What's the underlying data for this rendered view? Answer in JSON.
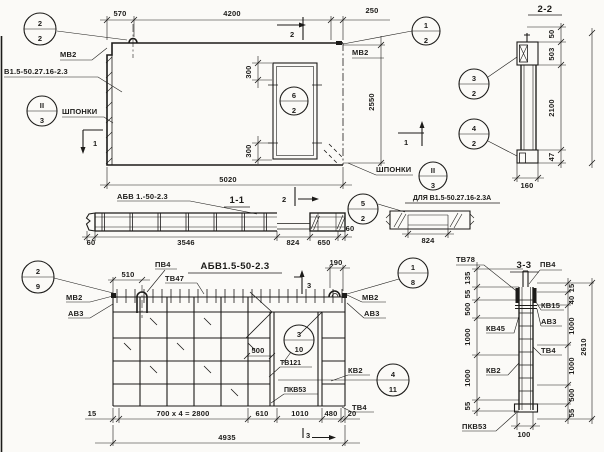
{
  "colors": {
    "ink": "#1c1b19",
    "paper": "#fbfaf7"
  },
  "plan": {
    "dims": {
      "d570": "570",
      "d4200": "4200",
      "d250": "250",
      "d5020": "5020",
      "d2550": "2550",
      "d300t": "300",
      "d300b": "300"
    },
    "labels": {
      "mv2_left": "МВ2",
      "mv2_right": "МВ2",
      "panel_mark": "В1.5-50.27.16-2.3",
      "shponki_left": "ШПОНКИ",
      "shponki_right": "ШПОНКИ",
      "abv": "АБВ 1.-50-2.3"
    },
    "marks": {
      "s1l": "1",
      "s1r": "1",
      "s2t": "2",
      "s2m": "2"
    }
  },
  "s11": {
    "title": "1-1",
    "caption_alt": "ДЛЯ В1.5-50.27.16-2.3А",
    "dims": {
      "d60l": "60",
      "d3546": "3546",
      "d824": "824",
      "d650": "650",
      "d60r": "60",
      "d824b": "824"
    }
  },
  "s22": {
    "title": "2-2",
    "dims": {
      "d50": "50",
      "d503": "503",
      "d2100": "2100",
      "d47": "47",
      "d160": "160"
    }
  },
  "plan2": {
    "title": "АБВ1.5-50-2.3",
    "labels": {
      "pv4": "ПВ4",
      "tv47": "ТВ47",
      "mv2l": "МВ2",
      "av3l": "АВ3",
      "mv2r": "МВ2",
      "av3r": "АВ3",
      "tv121": "ТВ121",
      "kv2": "КВ2",
      "pkv53": "ПКВ53",
      "tv4": "ТВ4"
    },
    "dims": {
      "d510": "510",
      "d190": "190",
      "d500": "500",
      "d15": "15",
      "d2800": "700 x 4 = 2800",
      "d610": "610",
      "d1010": "1010",
      "d480": "480",
      "d20": "20",
      "d4935": "4935"
    },
    "marks": {
      "s3t": "3",
      "s3b": "3"
    }
  },
  "s33": {
    "title": "3-3",
    "labels": {
      "tv78": "ТВ78",
      "pv4": "ПВ4",
      "kv15": "КВ15",
      "av3": "АВ3",
      "kv45": "КВ45",
      "kv2": "КВ2",
      "tv4": "ТВ4",
      "pkv53": "ПКВ53"
    },
    "dims_left": {
      "d135": "135",
      "d55t": "55",
      "d500": "500",
      "d1000a": "1000",
      "d1000b": "1000",
      "d55b": "55"
    },
    "dims_right": {
      "d15": "15",
      "d40": "40",
      "d1000a": "1000",
      "d1000b": "1000",
      "d500": "500",
      "d55": "55",
      "d2610": "2610",
      "d100": "100"
    }
  },
  "balloons": {
    "b2_2": {
      "top": "2",
      "bot": "2"
    },
    "b1_2": {
      "top": "1",
      "bot": "2"
    },
    "bII3a": {
      "top": "II",
      "bot": "3"
    },
    "bII3b": {
      "top": "II",
      "bot": "3"
    },
    "b6_2": {
      "top": "6",
      "bot": "2"
    },
    "b3_2": {
      "top": "3",
      "bot": "2"
    },
    "b4_2": {
      "top": "4",
      "bot": "2"
    },
    "b5_2": {
      "top": "5",
      "bot": "2"
    },
    "b2_9": {
      "top": "2",
      "bot": "9"
    },
    "b1_8": {
      "top": "1",
      "bot": "8"
    },
    "b3_10": {
      "top": "3",
      "bot": "10"
    },
    "b4_11": {
      "top": "4",
      "bot": "11"
    }
  }
}
